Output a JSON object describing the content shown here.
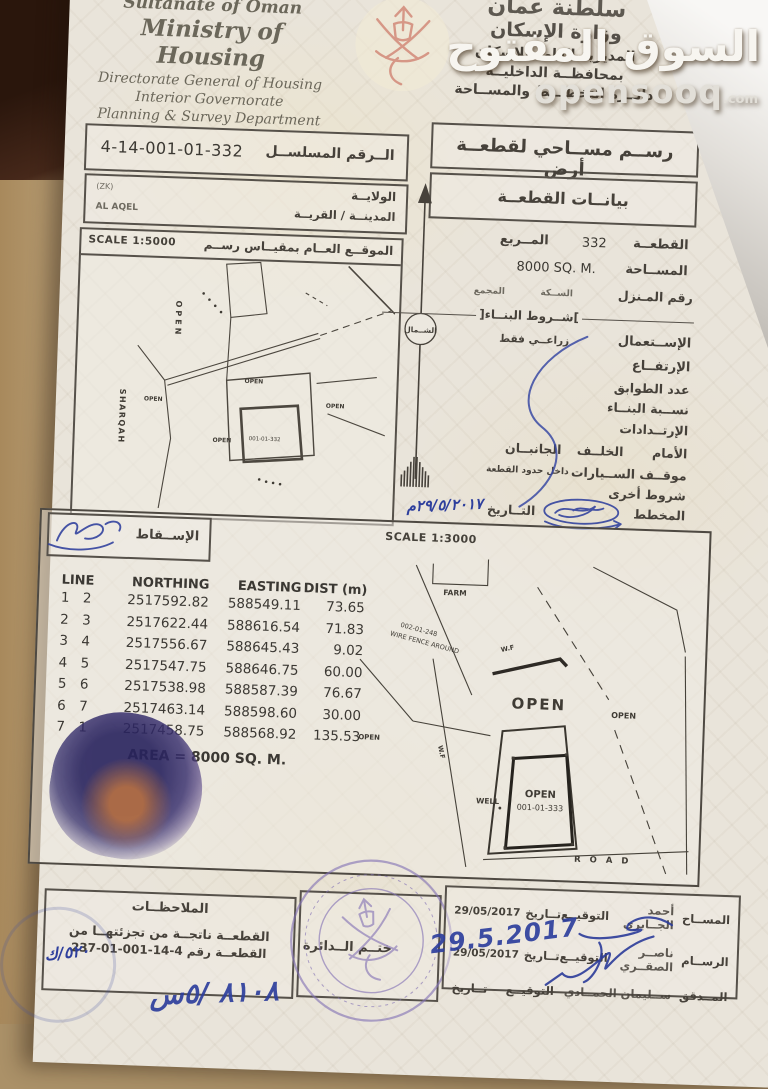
{
  "watermark": {
    "line1": "السوق المفتوح",
    "brand": "opensooq",
    "suffix": ".com"
  },
  "header": {
    "english": {
      "line1": "Sultanate of Oman",
      "line2": "Ministry of Housing",
      "line3": "Directorate General of Housing",
      "line4": "Interior Governorate",
      "line5": "Planning & Survey Department"
    },
    "arabic": {
      "line1": "سلطنة عمان",
      "line2": "وزارة الإسكان",
      "line3": "المديرية العامة للإسكان",
      "line4": "بمحافظــة الداخليــة",
      "line5": "دائــرة التخطيــط والمســاحة"
    }
  },
  "title_row": {
    "serial_label": "الــرقم المسلســل",
    "serial_value": "4-14-001-01-332",
    "doc_title": "رســم مســاحي لقطعــة أرض"
  },
  "location_row": {
    "wilaya_label": "الولايــة",
    "wilaya_value": "(ZK)",
    "town_label": "المدينــة / القريــة",
    "town_value": "AL AQEL",
    "plot_data_title": "بيانــات القطعــة"
  },
  "plot_details": {
    "plot_label": "القطعــة",
    "plot_value": "332",
    "block_label": "المــربع",
    "area_label": "المســاحة",
    "area_value": "8000 SQ. M.",
    "house_label": "رقم المـنزل",
    "lane_label": "الســكة",
    "complex_label": "المجمع",
    "building_terms_title": "شــروط البنــاء",
    "use_label": "الإســتعمال",
    "use_value": "زراعــي فقط",
    "height_label": "الإرتفــاع",
    "floors_label": "عدد الطوابق",
    "ratio_label": "نســبة البنــاء",
    "setbacks_label": "الإرتــدادات",
    "front_label": "الأمام",
    "back_label": "الخلــف",
    "sides_label": "الجانبــان",
    "parking_label": "موقــف الســيارات",
    "parking_value": "داخل حدود القطعة",
    "other_terms_label": "شروط أخرى",
    "planner_label": "المخطط",
    "date_label": "التــاريخ",
    "date_value_handwritten": "٢٩/٥/٢٠١٧م"
  },
  "north_label": "الشــمال",
  "location_map": {
    "scale": "SCALE 1:5000",
    "title": "الموقــع العــام بمقيــاس رســم",
    "labels": {
      "open_vertical": "OPEN",
      "sharqah": "SHARQAH",
      "open1": "OPEN",
      "open2": "OPEN",
      "open3": "OPEN",
      "open4": "OPEN",
      "plot_number": "001-01-332"
    }
  },
  "survey_section": {
    "projection_label": "الإســقاط",
    "scale": "SCALE 1:3000",
    "table": {
      "headers": [
        "LINE",
        "NORTHING",
        "EASTING",
        "DIST (m)"
      ],
      "rows": [
        [
          "1",
          "2",
          "2517592.82",
          "588549.11",
          "73.65"
        ],
        [
          "2",
          "3",
          "2517622.44",
          "588616.54",
          "71.83"
        ],
        [
          "3",
          "4",
          "2517556.67",
          "588645.43",
          "9.02"
        ],
        [
          "4",
          "5",
          "2517547.75",
          "588646.75",
          "60.00"
        ],
        [
          "5",
          "6",
          "2517538.98",
          "588587.39",
          "76.67"
        ],
        [
          "6",
          "7",
          "2517463.14",
          "588598.60",
          "30.00"
        ],
        [
          "7",
          "1",
          "2517458.75",
          "588568.92",
          "135.53"
        ]
      ],
      "area_note": "AREA = 8000 SQ. M."
    },
    "detail_map": {
      "labels": {
        "farm": "FARM",
        "fence_line1": "002-01-248",
        "fence_line2": "WIRE FENCE AROUND",
        "wf1": "W.F",
        "wf2": "W.F",
        "open_big": "OPEN",
        "open_right": "OPEN",
        "open_left": "OPEN",
        "well": "WELL",
        "open_plot": "OPEN",
        "plot_number": "001-01-333",
        "road": "R O A D"
      }
    }
  },
  "footer": {
    "notes": {
      "title": "الملاحظــات",
      "line1": "القطعــة ناتجــة من تجزئتهــا من",
      "line2": "القطعــة رقم 4-14-001-01-237",
      "handwritten": "٥٢٠/ك"
    },
    "stamp_label": "ختــم الــدائرة",
    "signatures": {
      "surveyor_role": "المســاح",
      "surveyor_name": "أحمد الجــابري",
      "surveyor_sign_label": "التوقيــع",
      "surveyor_date_label": "تــاريخ",
      "surveyor_date": "29/05/2017",
      "draftsman_role": "الرســام",
      "draftsman_name": "ناصــر الصقــري",
      "draftsman_sign_label": "التوقيــع",
      "draftsman_date_label": "تــاريخ",
      "draftsman_date": "29/05/2017",
      "checker_role": "المــدقق",
      "checker_name": "ســليمان الحمــادي",
      "checker_sign_label": "التوقيــع",
      "checker_date_label": "تــاريخ",
      "checker_date_handwritten": "29.5.2017"
    },
    "bottom_handwriting": "٨١٠٨ /٥س"
  },
  "colors": {
    "ink_blue": "#2e3f9d",
    "stamp_purple": "#8372b5",
    "paper": "#e9e4da",
    "emblem_red": "#d08272"
  }
}
